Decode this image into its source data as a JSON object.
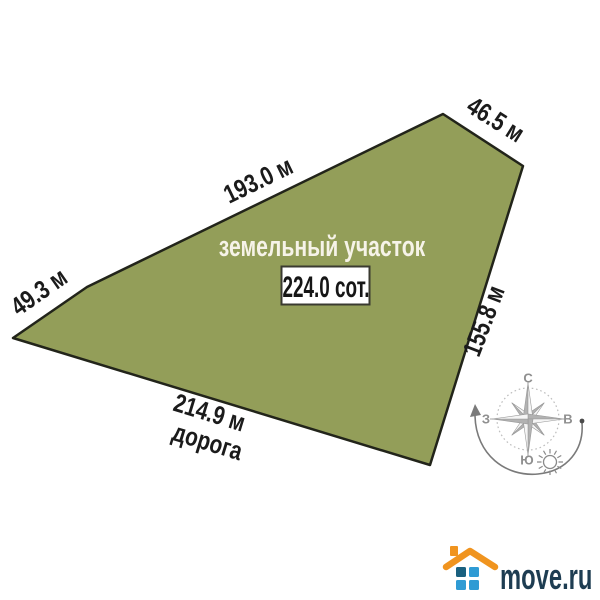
{
  "diagram": {
    "plot_label": "земельный участок",
    "area_value": "224.0 сот.",
    "road_label": "дорога",
    "edge_labels": {
      "top_left": "193.0 м",
      "top_right": "46.5 м",
      "left": "49.3 м",
      "right": "155.8 м",
      "bottom": "214.9 м"
    },
    "colors": {
      "plot_fill": "#939e59",
      "plot_stroke": "#22241a",
      "edge_label_text": "#1b1b1b",
      "plot_label_text": "#f6f3e8",
      "area_box_bg": "#ffffff",
      "area_box_border": "#3a3a30"
    }
  },
  "compass": {
    "north": "С",
    "south": "Ю",
    "west": "З",
    "east": "В",
    "color": "#8f8f8f"
  },
  "branding": {
    "logo_text": "move.ru",
    "colors": {
      "roof": "#f0941f",
      "square_dark": "#1a607f",
      "square_light": "#2f9bd4",
      "text": "#1e3d52"
    }
  }
}
